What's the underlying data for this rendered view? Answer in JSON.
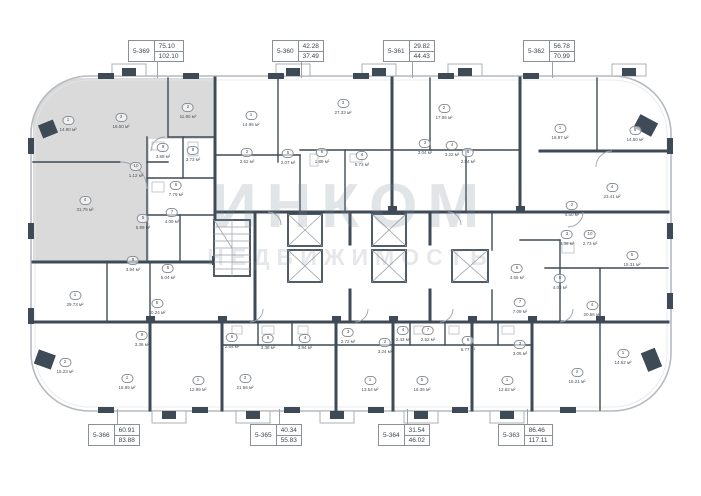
{
  "watermark": {
    "title": "ИНКОМ",
    "subtitle": "НЕДВИЖИМОСТЬ"
  },
  "units": {
    "top": [
      {
        "id": "5-369",
        "area_top": "75.10",
        "area_bottom": "102.10",
        "box_x": 128,
        "line_x": 157
      },
      {
        "id": "5-360",
        "area_top": "42.28",
        "area_bottom": "37.49",
        "box_x": 272,
        "line_x": 301
      },
      {
        "id": "5-361",
        "area_top": "29.82",
        "area_bottom": "44.43",
        "box_x": 383,
        "line_x": 412
      },
      {
        "id": "5-362",
        "area_top": "56.78",
        "area_bottom": "70.99",
        "box_x": 523,
        "line_x": 552
      }
    ],
    "bottom": [
      {
        "id": "5-366",
        "area_top": "60.91",
        "area_bottom": "83.88",
        "box_x": 88,
        "line_x": 117
      },
      {
        "id": "5-365",
        "area_top": "40.34",
        "area_bottom": "55.83",
        "box_x": 250,
        "line_x": 279
      },
      {
        "id": "5-364",
        "area_top": "31.54",
        "area_bottom": "46.02",
        "box_x": 378,
        "line_x": 407
      },
      {
        "id": "5-363",
        "area_top": "86.46",
        "area_bottom": "117.11",
        "box_x": 498,
        "line_x": 527
      }
    ]
  },
  "rooms": [
    {
      "num": "1",
      "area": "14.90 м²",
      "x": 68,
      "y": 120
    },
    {
      "num": "3",
      "area": "16.50 м²",
      "x": 121,
      "y": 117
    },
    {
      "num": "2",
      "area": "11.90 м²",
      "x": 188,
      "y": 107
    },
    {
      "num": "9",
      "area": "3.88 м²",
      "x": 163,
      "y": 147
    },
    {
      "num": "8",
      "area": "3.73 м²",
      "x": 193,
      "y": 150
    },
    {
      "num": "10",
      "area": "1.12 м²",
      "x": 136,
      "y": 166
    },
    {
      "num": "4",
      "area": "31.75 м²",
      "x": 85,
      "y": 200
    },
    {
      "num": "6",
      "area": "7.79 м²",
      "x": 176,
      "y": 185
    },
    {
      "num": "5",
      "area": "5.89 м²",
      "x": 143,
      "y": 218
    },
    {
      "num": "7",
      "area": "4.09 м²",
      "x": 172,
      "y": 212
    },
    {
      "num": "1",
      "area": "14.95 м²",
      "x": 251,
      "y": 115
    },
    {
      "num": "3",
      "area": "27.33 м²",
      "x": 343,
      "y": 103
    },
    {
      "num": "2",
      "area": "3.52 м²",
      "x": 247,
      "y": 152
    },
    {
      "num": "5",
      "area": "2.07 м²",
      "x": 288,
      "y": 153
    },
    {
      "num": "6",
      "area": "1.89 м²",
      "x": 322,
      "y": 152
    },
    {
      "num": "4",
      "area": "5.73 м²",
      "x": 362,
      "y": 155
    },
    {
      "num": "2",
      "area": "17.06 м²",
      "x": 444,
      "y": 108
    },
    {
      "num": "3",
      "area": "3.04 м²",
      "x": 425,
      "y": 143
    },
    {
      "num": "4",
      "area": "3.22 м²",
      "x": 452,
      "y": 145
    },
    {
      "num": "5",
      "area": "2.84 м²",
      "x": 468,
      "y": 152
    },
    {
      "num": "1",
      "area": "16.87 м²",
      "x": 560,
      "y": 128
    },
    {
      "num": "6",
      "area": "14.50 м²",
      "x": 635,
      "y": 130
    },
    {
      "num": "4",
      "area": "23.41 м²",
      "x": 612,
      "y": 187
    },
    {
      "num": "2",
      "area": "4.50 м²",
      "x": 572,
      "y": 205
    },
    {
      "num": "3",
      "area": "3.36 м²",
      "x": 567,
      "y": 234
    },
    {
      "num": "10",
      "area": "2.73 м²",
      "x": 590,
      "y": 234
    },
    {
      "num": "5",
      "area": "15.31 м²",
      "x": 632,
      "y": 255
    },
    {
      "num": "7",
      "area": "7.09 м²",
      "x": 520,
      "y": 302
    },
    {
      "num": "5",
      "area": "4.65 м²",
      "x": 517,
      "y": 268
    },
    {
      "num": "6",
      "area": "4.03 м²",
      "x": 560,
      "y": 278
    },
    {
      "num": "4",
      "area": "20.56 м²",
      "x": 592,
      "y": 305
    },
    {
      "num": "1",
      "area": "14.62 м²",
      "x": 623,
      "y": 353
    },
    {
      "num": "2",
      "area": "15.21 м²",
      "x": 577,
      "y": 372
    },
    {
      "num": "1",
      "area": "12.62 м²",
      "x": 507,
      "y": 380
    },
    {
      "num": "3",
      "area": "3.05 м²",
      "x": 520,
      "y": 344
    },
    {
      "num": "1",
      "area": "13.54 м²",
      "x": 370,
      "y": 380
    },
    {
      "num": "2",
      "area": "3.24 м²",
      "x": 385,
      "y": 342
    },
    {
      "num": "3",
      "area": "2.72 м²",
      "x": 348,
      "y": 332
    },
    {
      "num": "4",
      "area": "2.43 м²",
      "x": 403,
      "y": 330
    },
    {
      "num": "3",
      "area": "21.56 м²",
      "x": 245,
      "y": 378
    },
    {
      "num": "5",
      "area": "3.38 м²",
      "x": 268,
      "y": 338
    },
    {
      "num": "4",
      "area": "3.84 м²",
      "x": 305,
      "y": 338
    },
    {
      "num": "6",
      "area": "2.54 м²",
      "x": 232,
      "y": 337
    },
    {
      "num": "5",
      "area": "16.35 м²",
      "x": 422,
      "y": 380
    },
    {
      "num": "7",
      "area": "2.52 м²",
      "x": 428,
      "y": 330
    },
    {
      "num": "6",
      "area": "5.77 м²",
      "x": 468,
      "y": 340
    },
    {
      "num": "1",
      "area": "29.73 м²",
      "x": 75,
      "y": 295
    },
    {
      "num": "2",
      "area": "15.23 м²",
      "x": 65,
      "y": 362
    },
    {
      "num": "6",
      "area": "10.24 м²",
      "x": 157,
      "y": 303
    },
    {
      "num": "8",
      "area": "3.94 м²",
      "x": 133,
      "y": 260
    },
    {
      "num": "5",
      "area": "5.04 м²",
      "x": 168,
      "y": 268
    },
    {
      "num": "1",
      "area": "15.99 м²",
      "x": 127,
      "y": 378
    },
    {
      "num": "1",
      "area": "12.99 м²",
      "x": 198,
      "y": 380
    },
    {
      "num": "9",
      "area": "3.36 м²",
      "x": 142,
      "y": 335
    }
  ],
  "colors": {
    "wall": "#3E4A56",
    "outline": "#b5bbc1",
    "selected_unit_fill": "#d9dad9",
    "watermark": "#7d8896"
  }
}
